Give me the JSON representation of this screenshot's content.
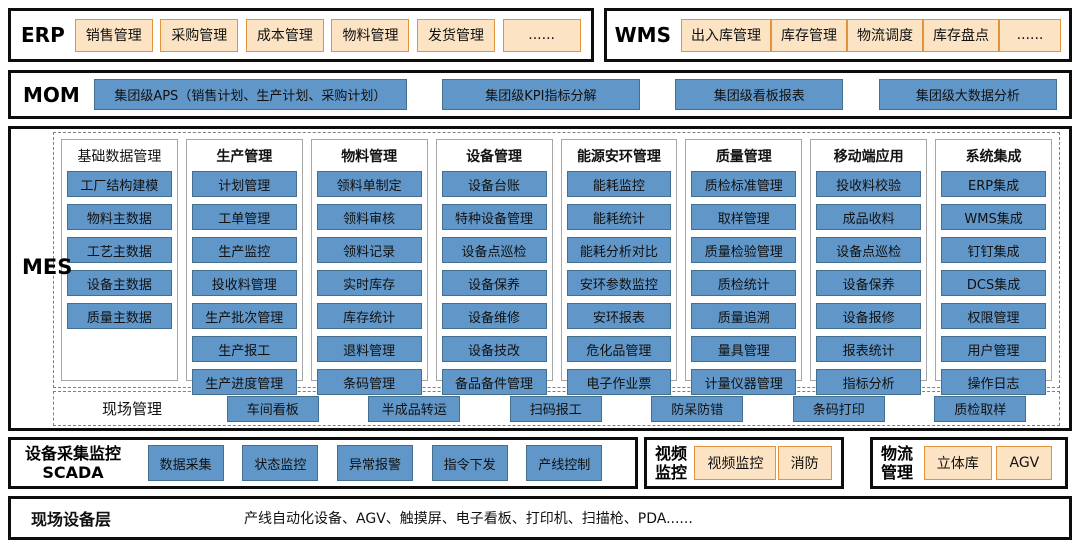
{
  "colors": {
    "blue": "#6096C8",
    "blue_border": "#44708F",
    "orange": "#FBE3C3",
    "orange_border": "#E2933C",
    "dash_gray": "#7f7f7f",
    "col_border": "#a6a6a6"
  },
  "erp": {
    "label": "ERP",
    "items": [
      "销售管理",
      "采购管理",
      "成本管理",
      "物料管理",
      "发货管理",
      "......"
    ]
  },
  "wms": {
    "label": "WMS",
    "items": [
      "出入库管理",
      "库存管理",
      "物流调度",
      "库存盘点",
      "......"
    ]
  },
  "mom": {
    "label": "MOM",
    "items": [
      "集团级APS（销售计划、生产计划、采购计划）",
      "集团级KPI指标分解",
      "集团级看板报表",
      "集团级大数据分析"
    ]
  },
  "mes": {
    "label": "MES",
    "columns": [
      {
        "header": "基础数据管理",
        "items": [
          "工厂结构建模",
          "物料主数据",
          "工艺主数据",
          "设备主数据",
          "质量主数据"
        ]
      },
      {
        "header": "生产管理",
        "items": [
          "计划管理",
          "工单管理",
          "生产监控",
          "投收料管理",
          "生产批次管理",
          "生产报工",
          "生产进度管理"
        ]
      },
      {
        "header": "物料管理",
        "items": [
          "领料单制定",
          "领料审核",
          "领料记录",
          "实时库存",
          "库存统计",
          "退料管理",
          "条码管理"
        ]
      },
      {
        "header": "设备管理",
        "items": [
          "设备台账",
          "特种设备管理",
          "设备点巡检",
          "设备保养",
          "设备维修",
          "设备技改",
          "备品备件管理"
        ]
      },
      {
        "header": "能源安环管理",
        "items": [
          "能耗监控",
          "能耗统计",
          "能耗分析对比",
          "安环参数监控",
          "安环报表",
          "危化品管理",
          "电子作业票"
        ]
      },
      {
        "header": "质量管理",
        "items": [
          "质检标准管理",
          "取样管理",
          "质量检验管理",
          "质检统计",
          "质量追溯",
          "量具管理",
          "计量仪器管理"
        ]
      },
      {
        "header": "移动端应用",
        "items": [
          "投收料校验",
          "成品收料",
          "设备点巡检",
          "设备保养",
          "设备报修",
          "报表统计",
          "指标分析"
        ]
      },
      {
        "header": "系统集成",
        "items": [
          "ERP集成",
          "WMS集成",
          "钉钉集成",
          "DCS集成",
          "权限管理",
          "用户管理",
          "操作日志"
        ]
      }
    ],
    "site": {
      "label": "现场管理",
      "items": [
        "车间看板",
        "半成品转运",
        "扫码报工",
        "防呆防错",
        "条码打印",
        "质检取样"
      ]
    }
  },
  "scada": {
    "label_line1": "设备采集监控",
    "label_line2": "SCADA",
    "items": [
      "数据采集",
      "状态监控",
      "异常报警",
      "指令下发",
      "产线控制"
    ]
  },
  "video": {
    "label_line1": "视频",
    "label_line2": "监控",
    "items": [
      "视频监控",
      "消防"
    ]
  },
  "logistics": {
    "label_line1": "物流",
    "label_line2": "管理",
    "items": [
      "立体库",
      "AGV"
    ]
  },
  "field": {
    "label": "现场设备层",
    "text": "产线自动化设备、AGV、触摸屏、电子看板、打印机、扫描枪、PDA......"
  }
}
